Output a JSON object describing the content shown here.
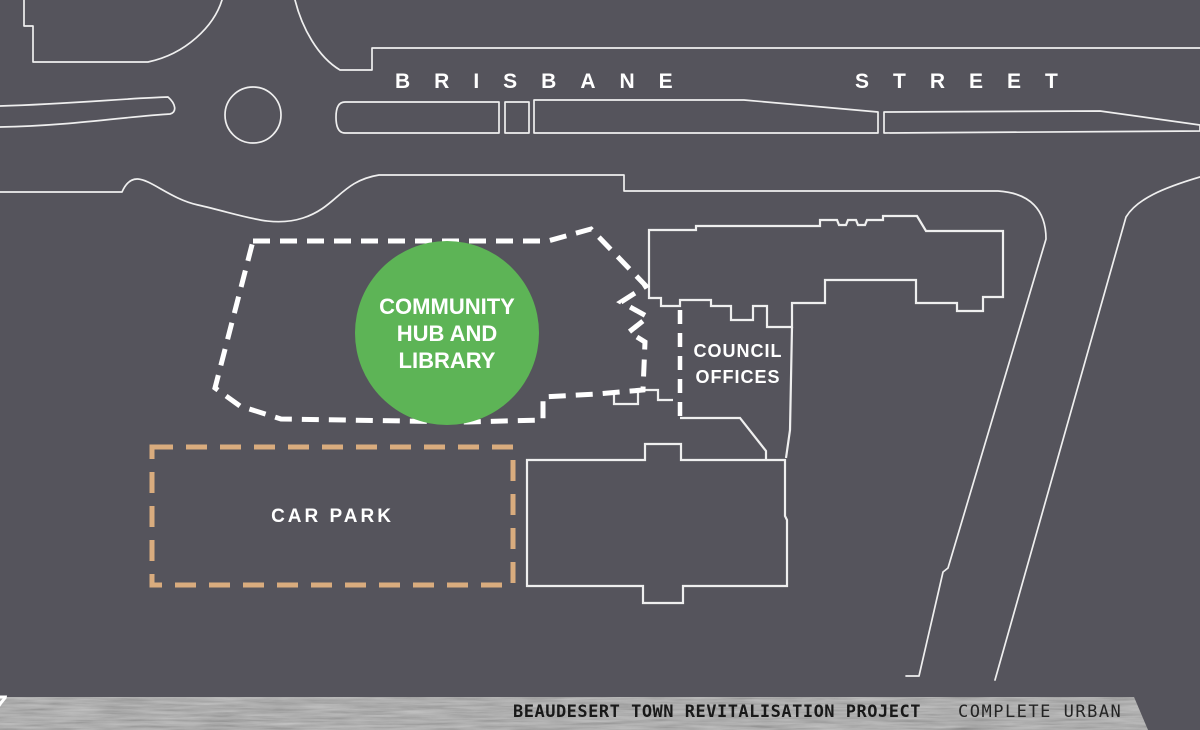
{
  "title": "Beaudesert Town Revitalisation Project site plan",
  "colors": {
    "background": "#55545c",
    "line": "#efefef",
    "hub_green": "#5db456",
    "carpark_dash": "#d9ac7e",
    "label_text": "#ffffff",
    "footer_text": "#191919",
    "footer_base": "#a3a3a3"
  },
  "streets": {
    "name_part1": "BRISBANE",
    "name_part2": "STREET"
  },
  "sites": {
    "hub": {
      "lines": [
        "COMMUNITY",
        "HUB AND",
        "LIBRARY"
      ]
    },
    "council": {
      "lines": [
        "COUNCIL",
        "OFFICES"
      ]
    },
    "carpark": {
      "label": "CAR PARK"
    }
  },
  "footer": {
    "page_number": "7",
    "project_title": "BEAUDESERT TOWN REVITALISATION PROJECT",
    "firm_name": "COMPLETE URBAN"
  }
}
